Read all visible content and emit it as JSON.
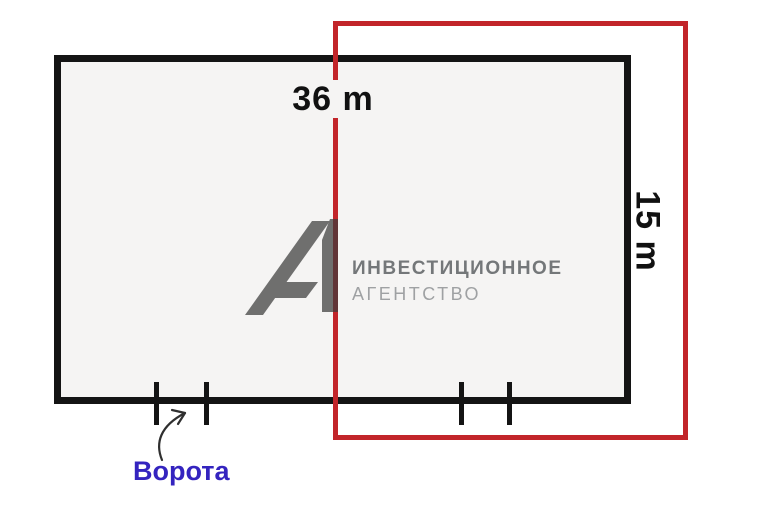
{
  "canvas": {
    "background": "#ffffff"
  },
  "plan": {
    "outline_color": "#141414",
    "interior_color": "#f5f4f3",
    "width_label": "36 m",
    "height_label": "15 m",
    "overlay_color": "#c2252a",
    "gates": {
      "label": "Ворота",
      "label_color": "#3424bf",
      "pairs_of_ticks": 2
    }
  },
  "watermark": {
    "logo": "А1",
    "line1": "ИНВЕСТИЦИОННОЕ",
    "line2": "АГЕНТСТВО",
    "logo_color": "#5a5a5a"
  }
}
